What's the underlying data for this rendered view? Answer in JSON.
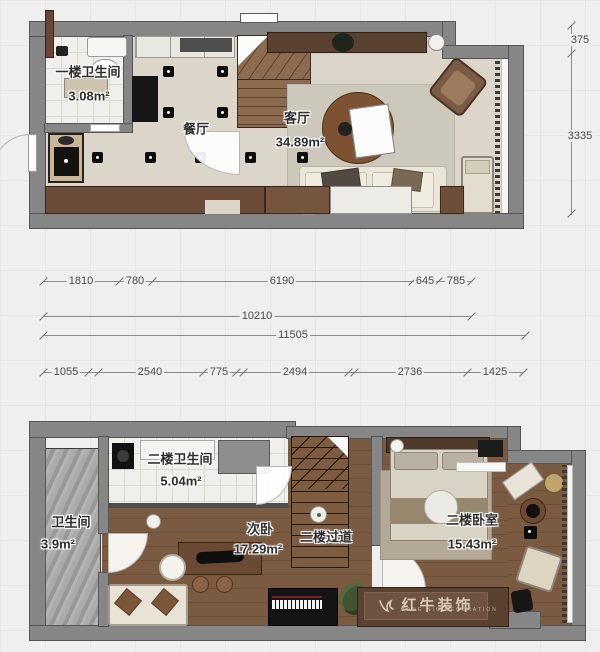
{
  "floor1": {
    "rooms": {
      "bath": {
        "label": "一楼卫生间",
        "area": "3.08m²"
      },
      "dining": {
        "label": "餐厅"
      },
      "living": {
        "label": "客厅",
        "area": "34.89m²"
      }
    },
    "dims_vertical": [
      "375",
      "3335"
    ]
  },
  "dimension_rows": {
    "row1": [
      "1810",
      "780",
      "6190",
      "645",
      "785"
    ],
    "row2": "10210",
    "row3": "11505",
    "row4": [
      "1055",
      "2540",
      "775",
      "2494",
      "2736",
      "1425"
    ]
  },
  "floor2": {
    "rooms": {
      "bath_left": {
        "label": "卫生间",
        "area": "3.9m²"
      },
      "bath_top": {
        "label": "二楼卫生间",
        "area": "5.04m²"
      },
      "second_bedroom": {
        "label": "次卧",
        "area": "17.29m²"
      },
      "hallway": {
        "label": "二楼过道"
      },
      "master_bedroom": {
        "label": "二楼卧室",
        "area": "15.43m²"
      }
    },
    "watermark": {
      "brand": "红牛装饰",
      "subtext": "HONG NIU DECORATION"
    }
  },
  "colors": {
    "wall": "#868686",
    "wood_floor": "#7b5a42",
    "tile_floor": "#f0efec",
    "beige_floor": "#dcd5c9",
    "accent_brown": "#5d4432",
    "watermark_plate": "#6e5440"
  }
}
